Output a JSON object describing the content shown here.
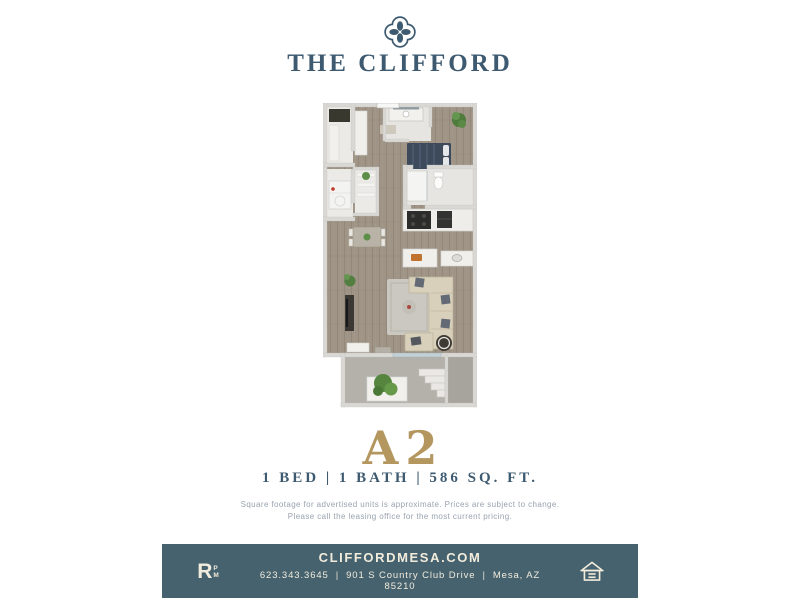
{
  "colors": {
    "brand_teal": "#3d5a70",
    "accent_gold": "#b4965f",
    "footer_bg": "#46626f",
    "footer_text": "#f2ecdc",
    "disclaimer_text": "#99a2ae",
    "page_bg": "#ffffff"
  },
  "header": {
    "logo_icon": "quatrefoil-logo-icon",
    "title": "THE CLIFFORD"
  },
  "floorplan": {
    "label": "3D rendered floor plan of unit A2: bedroom with bed, bathroom with vanity, closets, laundry, kitchen with island, dining table, living room with sectional sofa and rug, patio with plant, stairs and storage"
  },
  "unit": {
    "name": "A2",
    "specs": "1 BED | 1 BATH | 586 SQ. FT.",
    "disclaimer": {
      "line1": "Square footage for advertised units is approximate. Prices are subject to change.",
      "line2": "Please call the leasing office for the most current pricing."
    }
  },
  "footer": {
    "management_logo": {
      "main": "R",
      "sub_top": "P",
      "sub_bottom": "M"
    },
    "website": "CLIFFORDMESA.COM",
    "phone": "623.343.3645",
    "separator": "|",
    "address": "901 S Country Club Drive",
    "city_state_zip": "Mesa, AZ 85210",
    "equal_housing_icon": "equal-housing-opportunity-icon"
  }
}
